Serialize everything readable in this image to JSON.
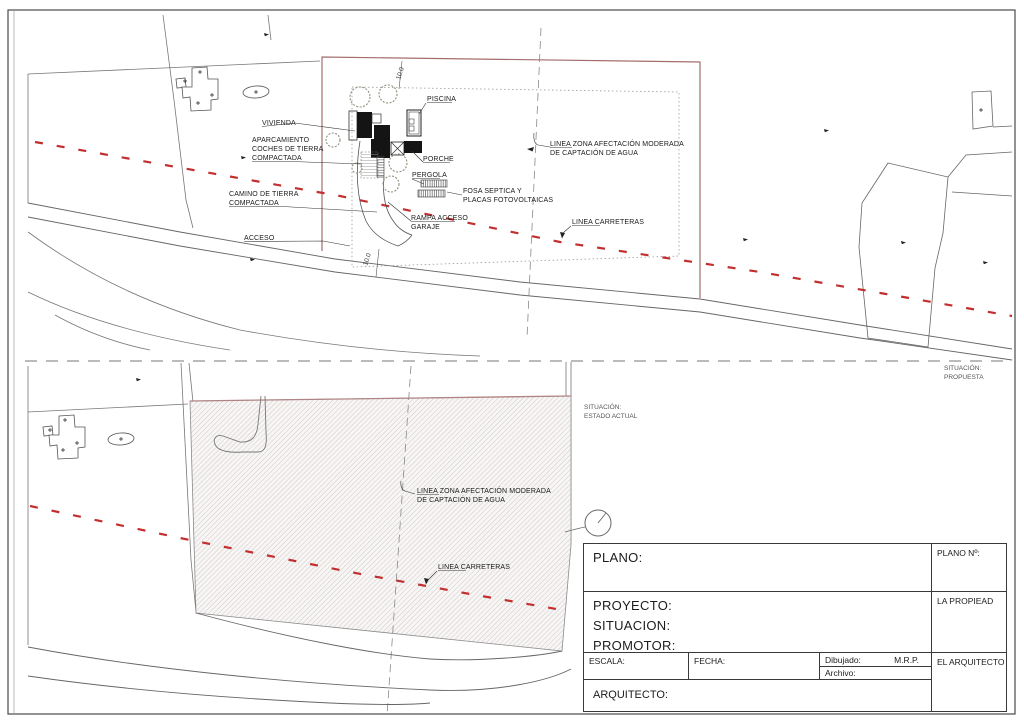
{
  "colors": {
    "red_dash": "#C22F2F",
    "boundary_red": "#A56D6D",
    "hatch_edge": "#B08484"
  },
  "plan_propuesta": {
    "labels": {
      "vivienda": "VIVIENDA",
      "piscina": "PISCINA",
      "aparcamiento": [
        "APARCAMIENTO",
        "COCHES DE TIERRA",
        "COMPACTADA"
      ],
      "camino": [
        "CAMINO DE TIERRA",
        "COMPACTADA"
      ],
      "acceso": "ACCESO",
      "porche": "PORCHE",
      "pergola": "PERGOLA",
      "fosa": [
        "FOSA SEPTICA Y",
        "PLACAS FOTOVOLTAICAS"
      ],
      "rampa": [
        "RAMPA ACCESO",
        "GARAJE"
      ],
      "linea_zona": [
        "LINEA ZONA AFECTACIÓN MODERADA",
        "DE CAPTACIÓN DE AGUA"
      ],
      "linea_carreteras": "LINEA CARRETERAS",
      "dim_top": "10.0",
      "dim_bottom": "10.0",
      "situacion": [
        "SITUACIÓN:",
        "PROPUESTA"
      ]
    }
  },
  "plan_estado": {
    "labels": {
      "situacion": [
        "SITUACIÓN:",
        "ESTADO ACTUAL"
      ],
      "linea_zona": [
        "LINEA ZONA AFECTACIÓN MODERADA",
        "DE CAPTACIÓN DE AGUA"
      ],
      "linea_carreteras": "LINEA CARRETERAS"
    }
  },
  "title_block": {
    "plano": "PLANO:",
    "plano_n": "PLANO Nº:",
    "proyecto": "PROYECTO:",
    "situacion": "SITUACION:",
    "promotor": "PROMOTOR:",
    "la_propiedad": "LA PROPIEAD",
    "escala": "ESCALA:",
    "fecha": "FECHA:",
    "dibujado": "Dibujado:",
    "dibujado_value": "M.R.P.",
    "archivo": "Archivo:",
    "el_arquitecto": "EL ARQUITECTO",
    "arquitecto": "ARQUITECTO:"
  }
}
